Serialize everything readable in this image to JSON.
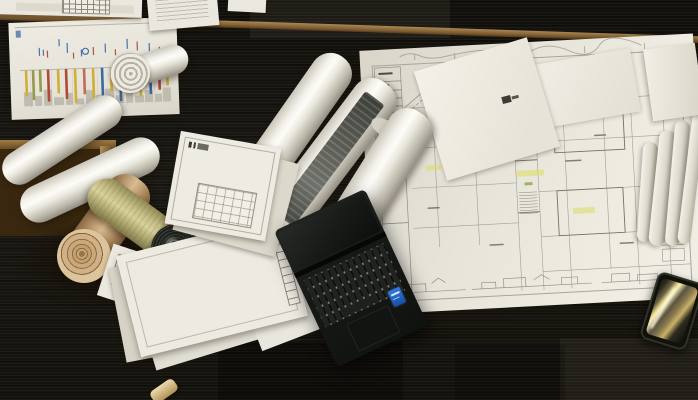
{
  "scene": {
    "description": "Top-down photograph of a wooden architect's desk on dark charcoal carpet. Rolled blueprints and aged drawing rolls sit on the left, a large architectural floor plan covers the right half, stacks of drawing sheets lie in the middle, an open black laptop sits at bottom-center and a smartphone rests on the desk edge at the right.",
    "floor": {
      "label": "dark carpet tiles",
      "color": "#16140f"
    },
    "desk": {
      "label": "wooden desk",
      "color_light": "#b98c4e",
      "color_dark": "#3f2a12"
    },
    "objects": [
      {
        "id": "floor-plan-sheet",
        "label": "large architectural floor plan with highlighter marks",
        "paper_color": "#e7e4da",
        "line_color": "#a49e92",
        "highlight_color": "#dede6e"
      },
      {
        "id": "elevation-sheet",
        "label": "street elevation sheet with colored bars",
        "bar_colors": [
          "#cfae3a",
          "#b0483c",
          "#3a68a0",
          "#98984a"
        ]
      },
      {
        "id": "blueprint-rolls",
        "label": "cluster of rolled drawings",
        "count": 8,
        "tan_roll_color": "#c2a074",
        "aged_roll_color": "#c5bd85",
        "dark_coil_color": "#20231d"
      },
      {
        "id": "cover-sheet",
        "label": "title sheet with small plan drawing"
      },
      {
        "id": "paper-stack",
        "label": "stack of white drawing sheets"
      },
      {
        "id": "top-documents",
        "label": "documents at top edge of frame"
      },
      {
        "id": "laptop",
        "label": "open black laptop with keyboard, touchpad and blue processor sticker",
        "body_color": "#161815",
        "sticker_color": "#2e7ae0"
      },
      {
        "id": "smartphone",
        "label": "smartphone with golden screen reflections",
        "reflection_color": "#e8d88e"
      },
      {
        "id": "crumb-object",
        "label": "small beige object at bottom edge"
      }
    ]
  }
}
